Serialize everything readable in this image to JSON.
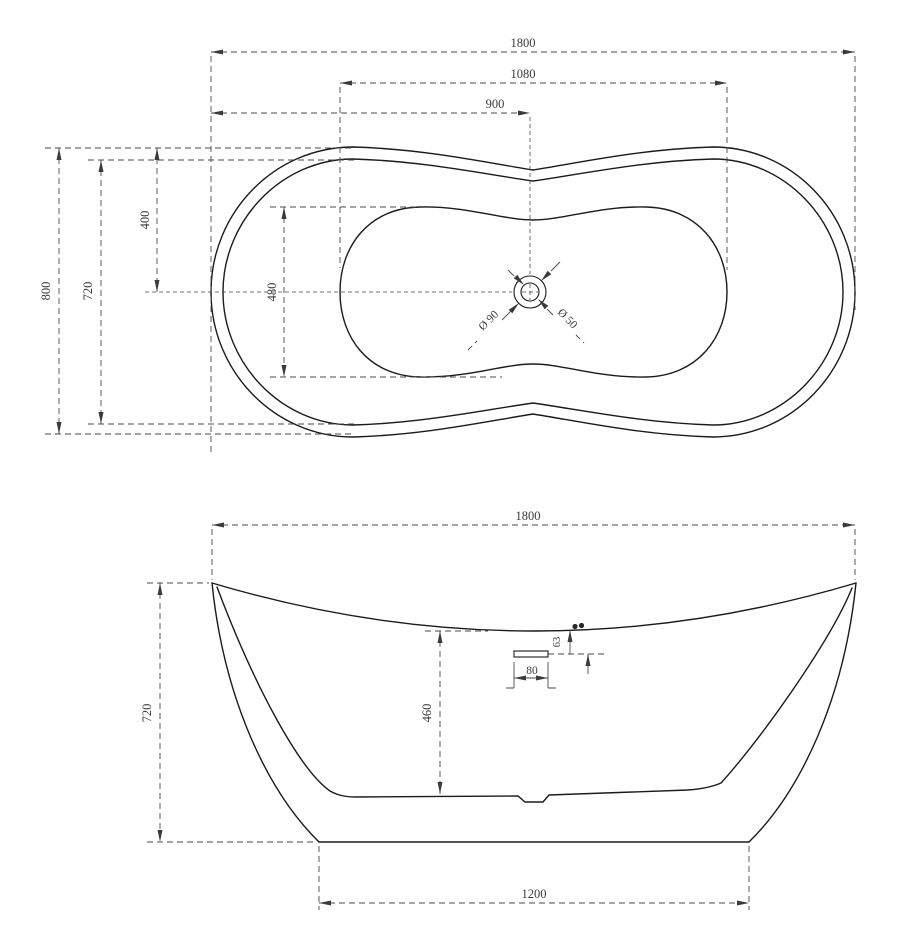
{
  "top_view": {
    "overall_length": "1800",
    "basin_length": "1080",
    "drain_offset_from_left": "900",
    "overall_width": "800",
    "rim_inner_width": "720",
    "centerline_from_top": "400",
    "basin_width": "480",
    "drain_outer_diameter": "Ø 90",
    "drain_hole_diameter": "Ø 50"
  },
  "front_view": {
    "overall_length": "1800",
    "overall_height": "720",
    "interior_depth": "460",
    "overflow_drop": "63",
    "overflow_width": "80",
    "base_length": "1200"
  }
}
